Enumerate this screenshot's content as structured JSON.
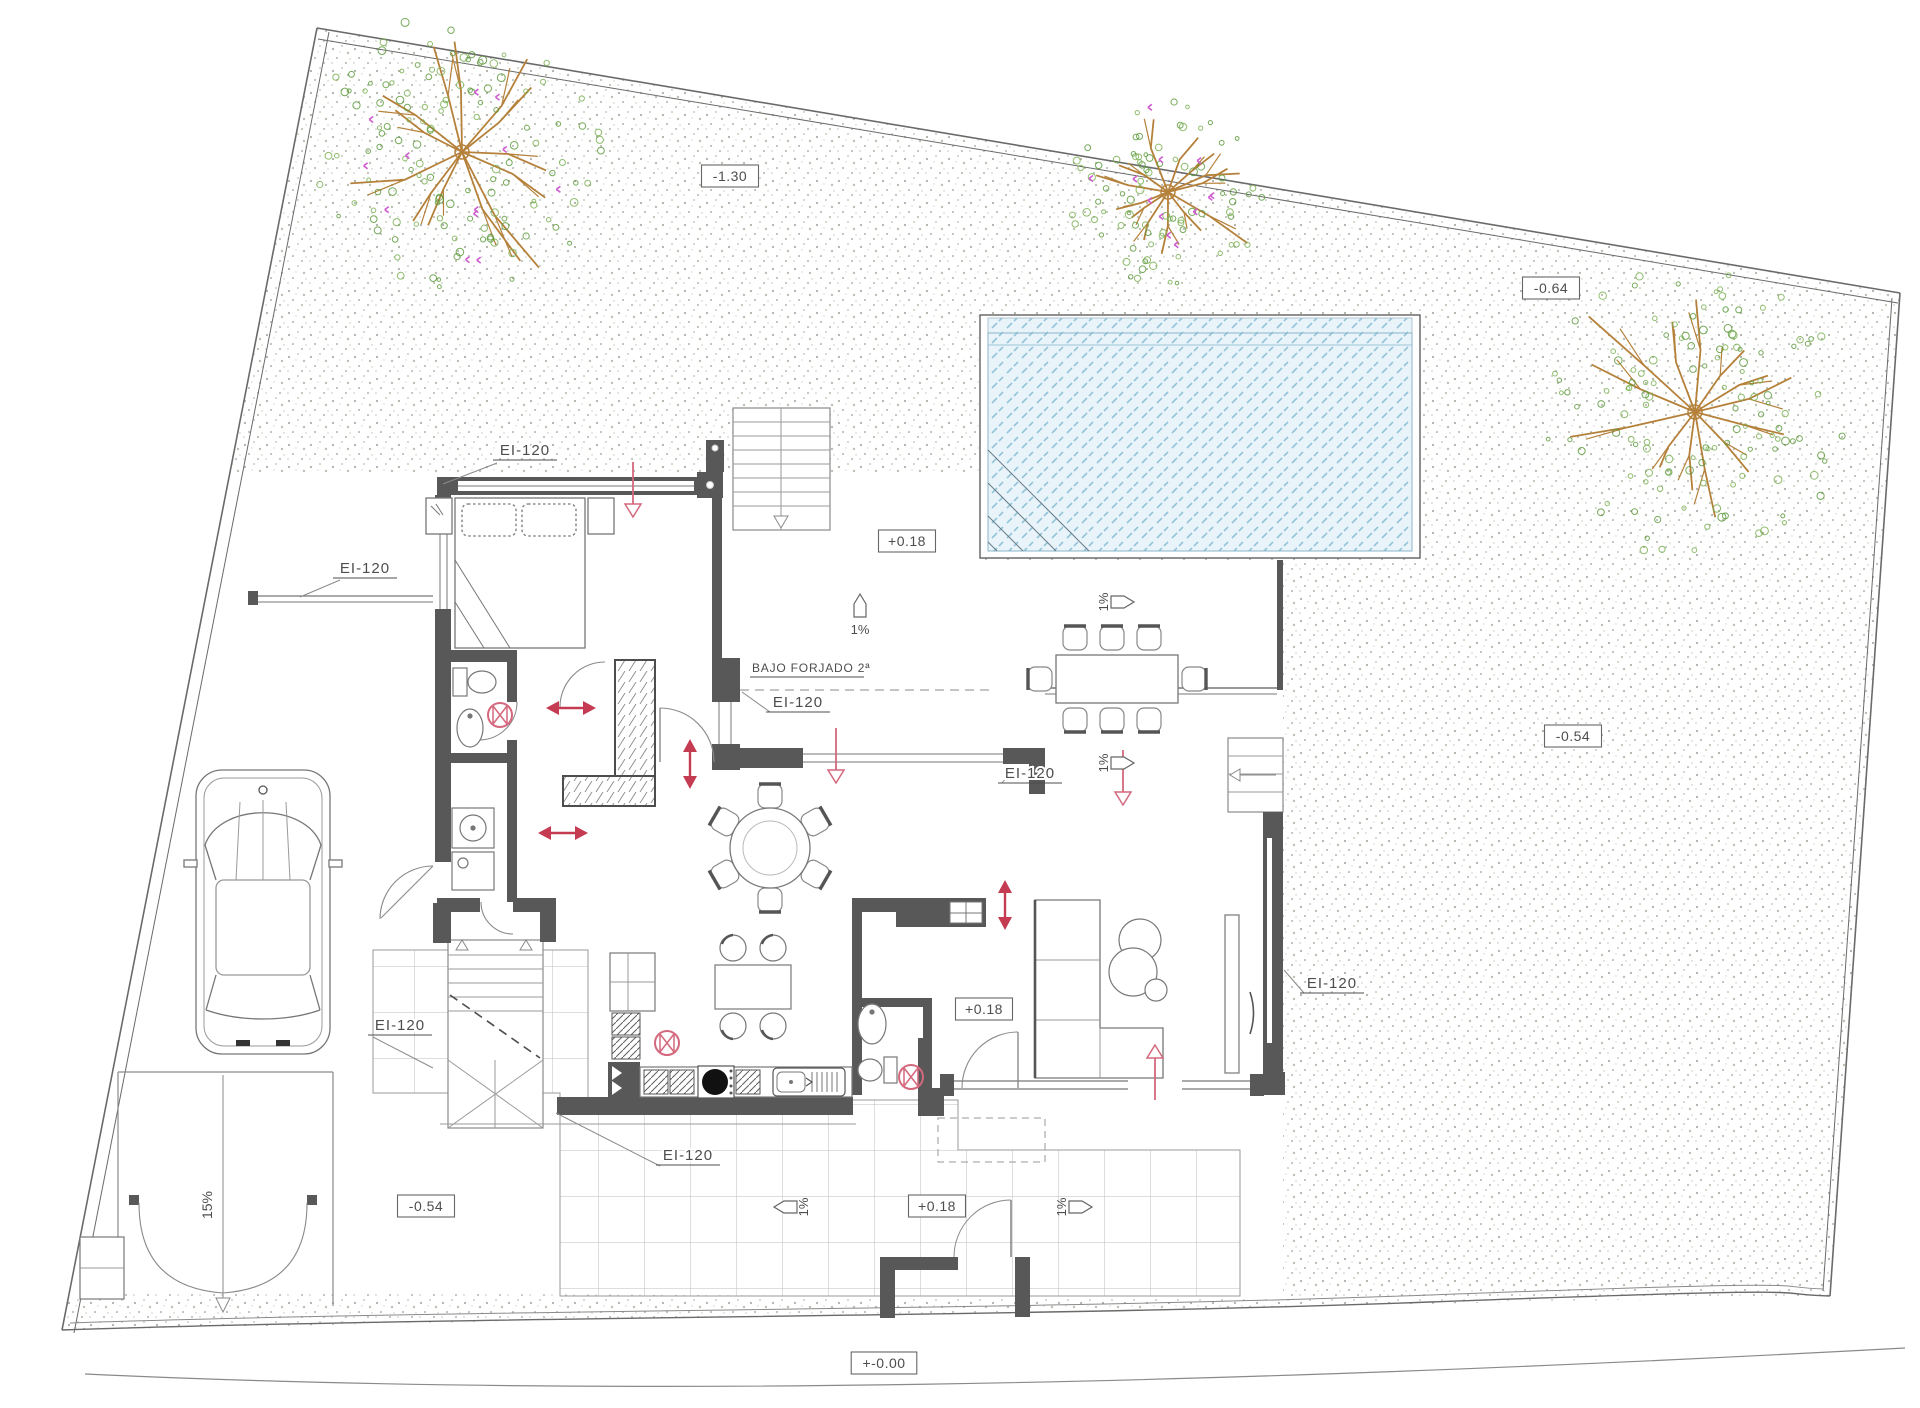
{
  "drawing": {
    "type": "architectural-site-plan",
    "colors": {
      "wall": "#585858",
      "line": "#777777",
      "thin_line": "#8a8a8a",
      "text": "#4d4d4d",
      "red": "#c43b52",
      "red_light": "#d4687d",
      "pool_water": "#e9f4fa",
      "pool_hatch": "#93c4da",
      "stipple_dot": "#98a08e",
      "grid_line": "#bdbdbd",
      "tree_branch": "#b5813a",
      "tree_leaf": "#7ab052",
      "tree_flower": "#cf5fd0"
    },
    "fire_labels": [
      {
        "text": "EI-120",
        "x": 525,
        "y": 455,
        "leader": "497,463 443,484"
      },
      {
        "text": "EI-120",
        "x": 365,
        "y": 573,
        "leader": "340,580 300,597"
      },
      {
        "text": "EI-120",
        "x": 798,
        "y": 707,
        "leader": "770,712 742,692"
      },
      {
        "text": "EI-120",
        "x": 1030,
        "y": 778,
        "leader": "1002,783 1014,768"
      },
      {
        "text": "EI-120",
        "x": 1332,
        "y": 988,
        "leader": "1304,993 1284,970"
      },
      {
        "text": "EI-120",
        "x": 400,
        "y": 1030,
        "leader": "373,1037 433,1068"
      },
      {
        "text": "EI-120",
        "x": 688,
        "y": 1160,
        "leader": "660,1166 556,1113"
      }
    ],
    "elevation_markers": [
      {
        "text": "-1.30",
        "x": 730,
        "y": 177
      },
      {
        "text": "-0.64",
        "x": 1551,
        "y": 289
      },
      {
        "text": "-0.54",
        "x": 1573,
        "y": 737
      },
      {
        "text": "-0.54",
        "x": 426,
        "y": 1207
      },
      {
        "text": "+0.18",
        "x": 907,
        "y": 542
      },
      {
        "text": "+0.18",
        "x": 984,
        "y": 1010
      },
      {
        "text": "+0.18",
        "x": 937,
        "y": 1207
      },
      {
        "text": "+-0.00",
        "x": 884,
        "y": 1364
      }
    ],
    "slope_arrows": [
      {
        "text": "1%",
        "x": 860,
        "y": 606,
        "dir": "up"
      },
      {
        "text": "1%",
        "x": 1122,
        "y": 602,
        "dir": "right"
      },
      {
        "text": "1%",
        "x": 1122,
        "y": 763,
        "dir": "right"
      },
      {
        "text": "1%",
        "x": 786,
        "y": 1207,
        "dir": "left"
      },
      {
        "text": "1%",
        "x": 1080,
        "y": 1207,
        "dir": "right"
      }
    ],
    "ramp_label": {
      "text": "15%",
      "x": 212,
      "y": 1205
    },
    "notes": [
      {
        "text": "BAJO FORJADO 2ª",
        "x": 752,
        "y": 672,
        "underline": 112
      }
    ],
    "red_symbols": [
      {
        "type": "light",
        "x": 500,
        "y": 715
      },
      {
        "type": "light",
        "x": 667,
        "y": 1043
      },
      {
        "type": "light",
        "x": 911,
        "y": 1077
      },
      {
        "type": "harrow",
        "x": 571,
        "y": 708
      },
      {
        "type": "harrow",
        "x": 563,
        "y": 833
      },
      {
        "type": "varrow",
        "x": 690,
        "y": 764
      },
      {
        "type": "varrow",
        "x": 1005,
        "y": 905
      },
      {
        "type": "down",
        "x": 633,
        "y": 490
      },
      {
        "type": "down",
        "x": 836,
        "y": 756
      },
      {
        "type": "down",
        "x": 1123,
        "y": 778
      },
      {
        "type": "up",
        "x": 1155,
        "y": 1072
      }
    ],
    "trees": [
      {
        "x": 462,
        "y": 152,
        "r": 150,
        "flowers": true
      },
      {
        "x": 1168,
        "y": 192,
        "r": 100,
        "flowers": true
      },
      {
        "x": 1695,
        "y": 412,
        "r": 155,
        "flowers": false
      }
    ]
  }
}
